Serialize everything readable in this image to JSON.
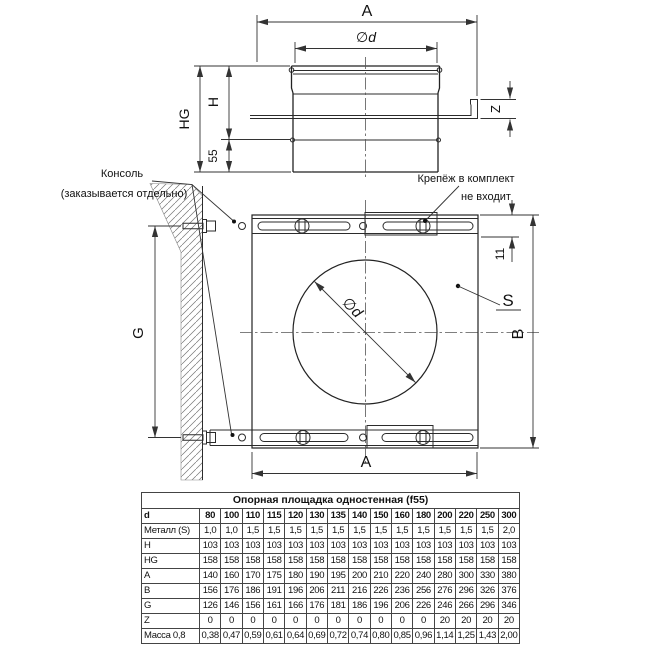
{
  "drawing_side": {
    "dim_a": "A",
    "dim_phi_d": "∅d",
    "dim_h": "H",
    "dim_hg": "HG",
    "dim_55": "55",
    "dim_z": "Z"
  },
  "drawing_front": {
    "dim_a": "A",
    "dim_b": "B",
    "dim_g": "G",
    "dim_11": "11",
    "dim_phi_d": "∅d",
    "label_s": "S",
    "note_console_1": "Консоль",
    "note_console_2": "(заказывается отдельно)",
    "note_fastener_1": "Крепёж в комплект",
    "note_fastener_2": "не входит"
  },
  "table": {
    "title": "Опорная площадка одностенная (f55)",
    "corner_label": "d",
    "diameters": [
      "80",
      "100",
      "110",
      "115",
      "120",
      "130",
      "135",
      "140",
      "150",
      "160",
      "180",
      "200",
      "220",
      "250",
      "300"
    ],
    "rows": [
      {
        "label": "Металл (S)",
        "values": [
          "1,0",
          "1,0",
          "1,5",
          "1,5",
          "1,5",
          "1,5",
          "1,5",
          "1,5",
          "1,5",
          "1,5",
          "1,5",
          "1,5",
          "1,5",
          "1,5",
          "2,0"
        ]
      },
      {
        "label": "H",
        "values": [
          "103",
          "103",
          "103",
          "103",
          "103",
          "103",
          "103",
          "103",
          "103",
          "103",
          "103",
          "103",
          "103",
          "103",
          "103"
        ]
      },
      {
        "label": "HG",
        "values": [
          "158",
          "158",
          "158",
          "158",
          "158",
          "158",
          "158",
          "158",
          "158",
          "158",
          "158",
          "158",
          "158",
          "158",
          "158"
        ]
      },
      {
        "label": "A",
        "values": [
          "140",
          "160",
          "170",
          "175",
          "180",
          "190",
          "195",
          "200",
          "210",
          "220",
          "240",
          "280",
          "300",
          "330",
          "380"
        ]
      },
      {
        "label": "B",
        "values": [
          "156",
          "176",
          "186",
          "191",
          "196",
          "206",
          "211",
          "216",
          "226",
          "236",
          "256",
          "276",
          "296",
          "326",
          "376"
        ]
      },
      {
        "label": "G",
        "values": [
          "126",
          "146",
          "156",
          "161",
          "166",
          "176",
          "181",
          "186",
          "196",
          "206",
          "226",
          "246",
          "266",
          "296",
          "346"
        ]
      },
      {
        "label": "Z",
        "values": [
          "0",
          "0",
          "0",
          "0",
          "0",
          "0",
          "0",
          "0",
          "0",
          "0",
          "0",
          "20",
          "20",
          "20",
          "20"
        ]
      },
      {
        "label": "Масса 0,8",
        "values": [
          "0,38",
          "0,47",
          "0,59",
          "0,61",
          "0,64",
          "0,69",
          "0,72",
          "0,74",
          "0,80",
          "0,85",
          "0,96",
          "1,14",
          "1,25",
          "1,43",
          "2,00"
        ]
      }
    ]
  },
  "colors": {
    "line": "#222222",
    "text": "#111111",
    "background": "#ffffff"
  }
}
